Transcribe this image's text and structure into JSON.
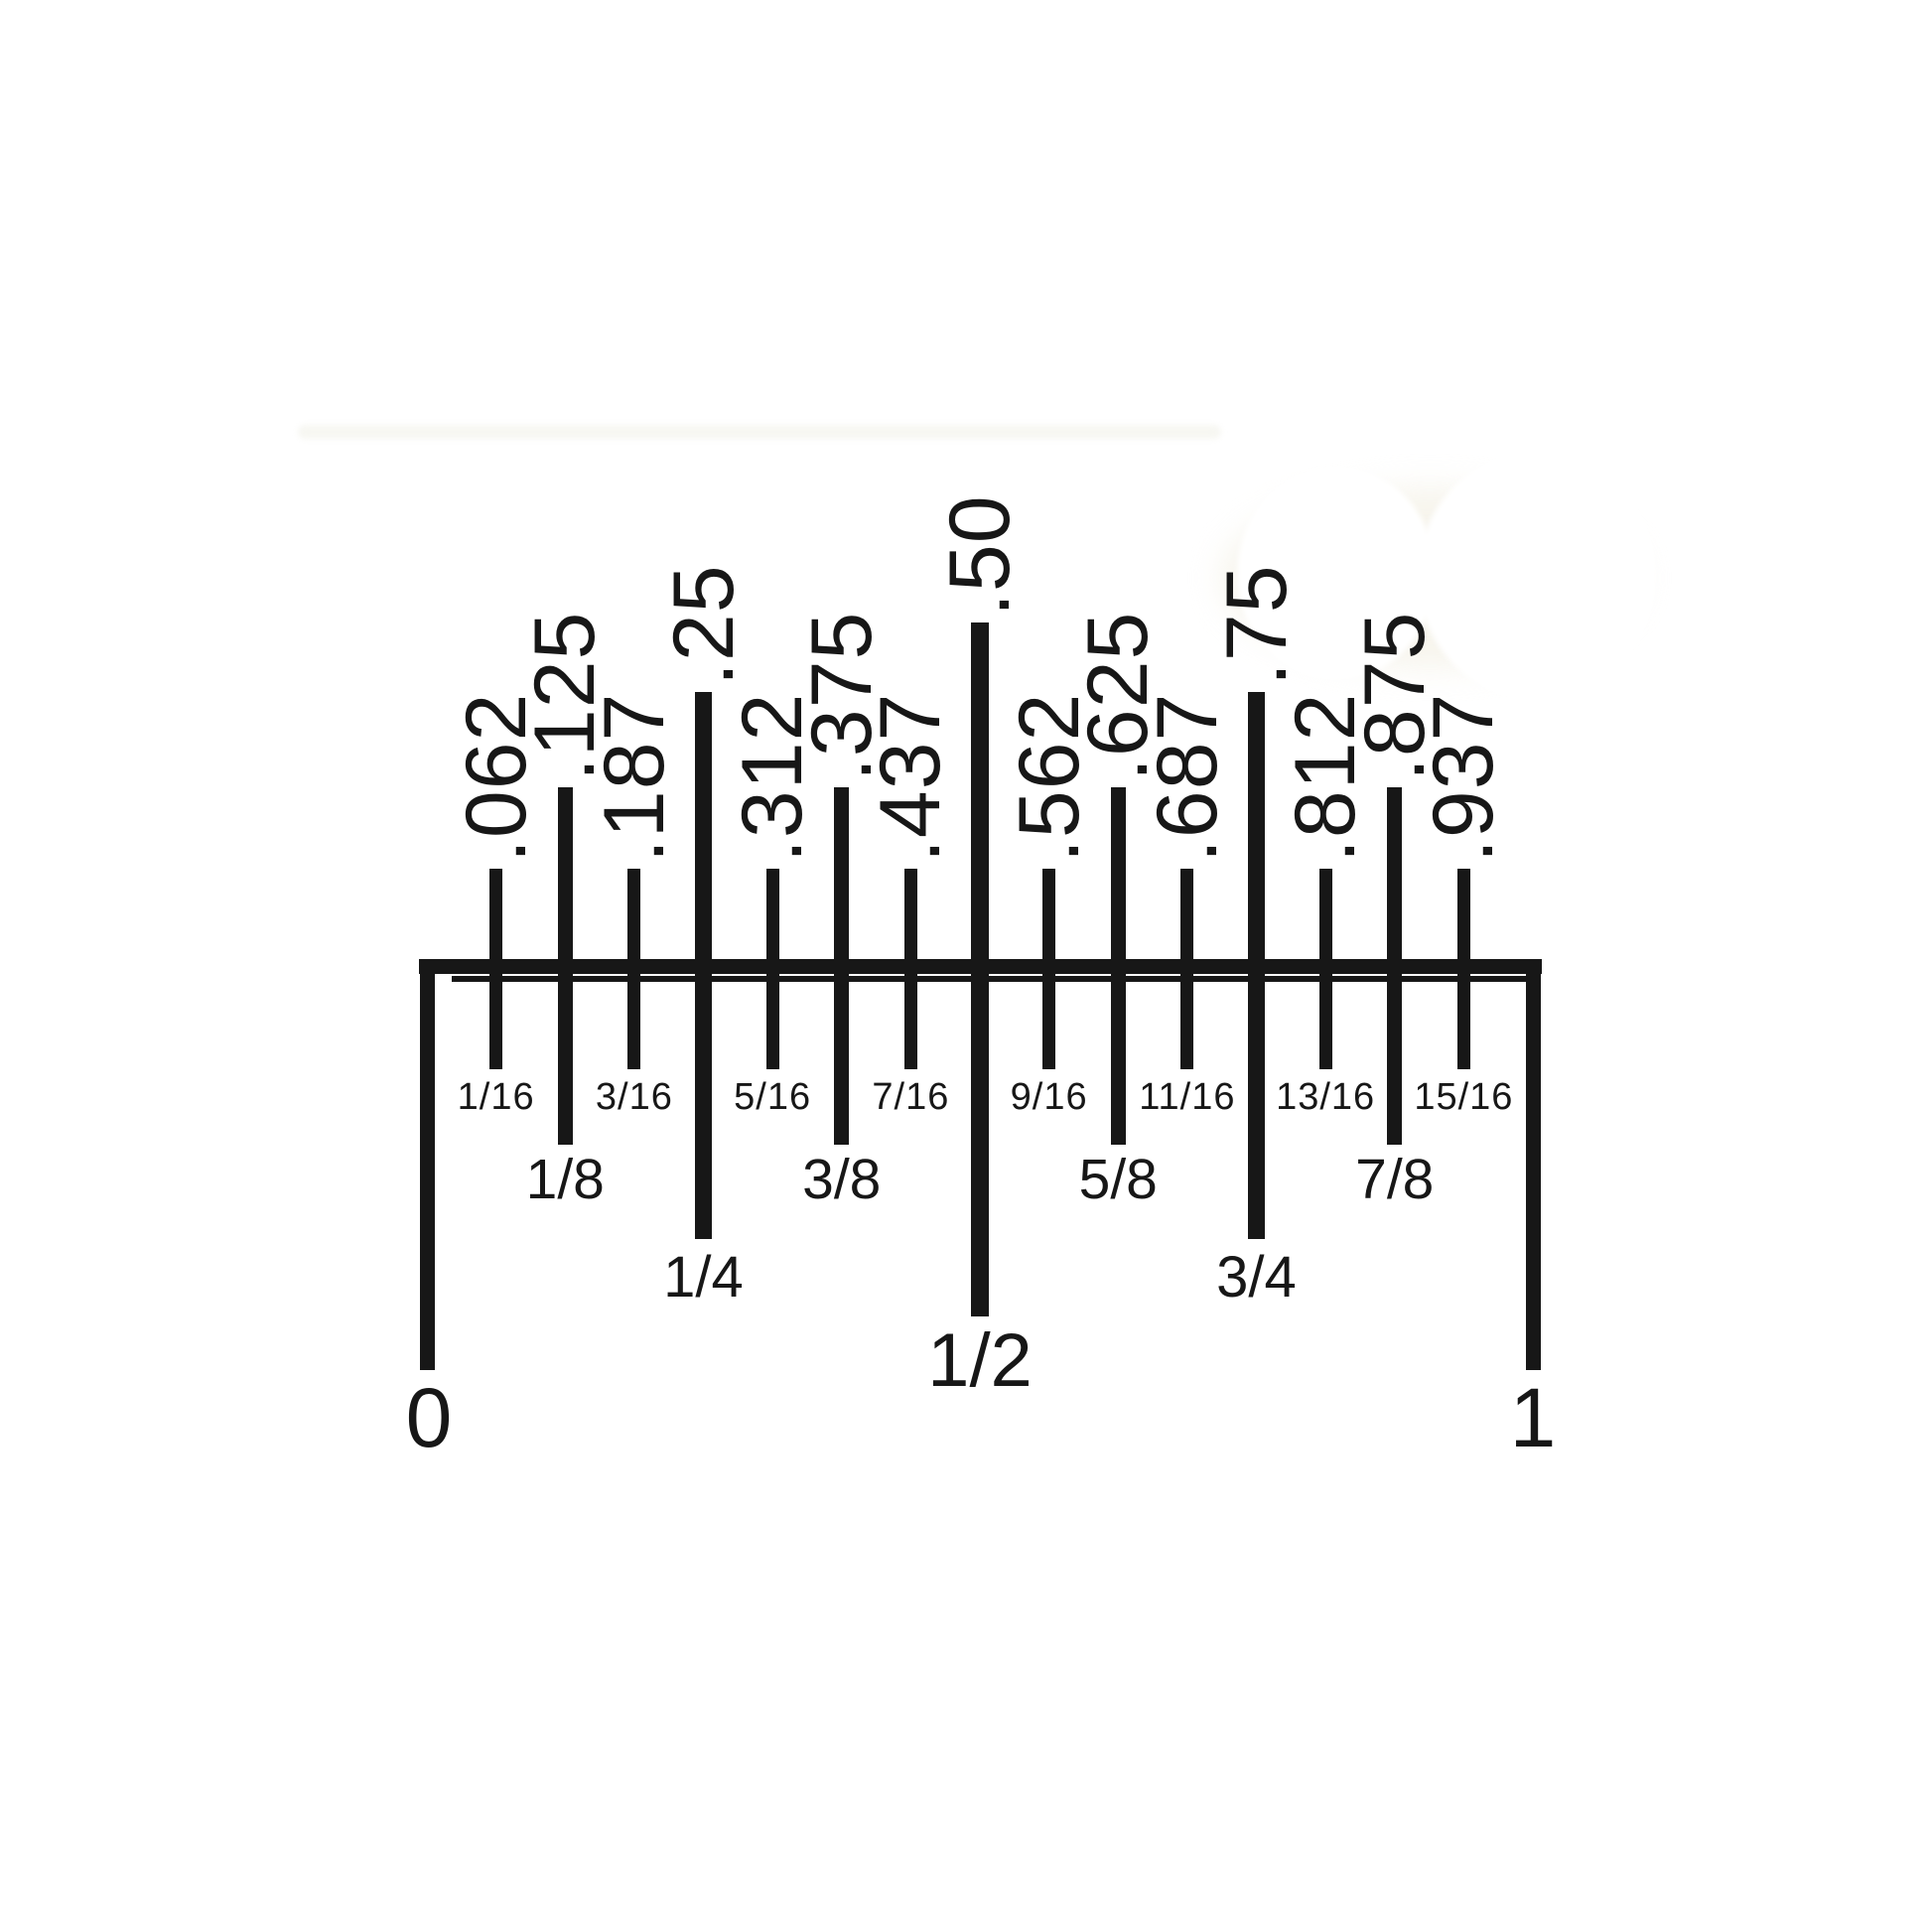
{
  "figure": {
    "kind": "inch-fraction-to-decimal-ruler-diagram",
    "background_color": "#ffffff",
    "ink_color": "#171717",
    "endpoints": {
      "start_label": "0",
      "end_label": "1"
    },
    "ticks": [
      {
        "sixteenths": 1,
        "level": "sixteenth",
        "decimal": ".062",
        "fraction": "1/16"
      },
      {
        "sixteenths": 2,
        "level": "eighth",
        "decimal": ".125",
        "fraction": "1/8"
      },
      {
        "sixteenths": 3,
        "level": "sixteenth",
        "decimal": ".187",
        "fraction": "3/16"
      },
      {
        "sixteenths": 4,
        "level": "quarter",
        "decimal": ".25",
        "fraction": "1/4"
      },
      {
        "sixteenths": 5,
        "level": "sixteenth",
        "decimal": ".312",
        "fraction": "5/16"
      },
      {
        "sixteenths": 6,
        "level": "eighth",
        "decimal": ".375",
        "fraction": "3/8"
      },
      {
        "sixteenths": 7,
        "level": "sixteenth",
        "decimal": ".437",
        "fraction": "7/16"
      },
      {
        "sixteenths": 8,
        "level": "half",
        "decimal": ".50",
        "fraction": "1/2"
      },
      {
        "sixteenths": 9,
        "level": "sixteenth",
        "decimal": ".562",
        "fraction": "9/16"
      },
      {
        "sixteenths": 10,
        "level": "eighth",
        "decimal": ".625",
        "fraction": "5/8"
      },
      {
        "sixteenths": 11,
        "level": "sixteenth",
        "decimal": ".687",
        "fraction": "11/16"
      },
      {
        "sixteenths": 12,
        "level": "quarter",
        "decimal": ".75",
        "fraction": "3/4"
      },
      {
        "sixteenths": 13,
        "level": "sixteenth",
        "decimal": ".812",
        "fraction": "13/16"
      },
      {
        "sixteenths": 14,
        "level": "eighth",
        "decimal": ".875",
        "fraction": "7/8"
      },
      {
        "sixteenths": 15,
        "level": "sixteenth",
        "decimal": ".937",
        "fraction": "15/16"
      }
    ]
  }
}
